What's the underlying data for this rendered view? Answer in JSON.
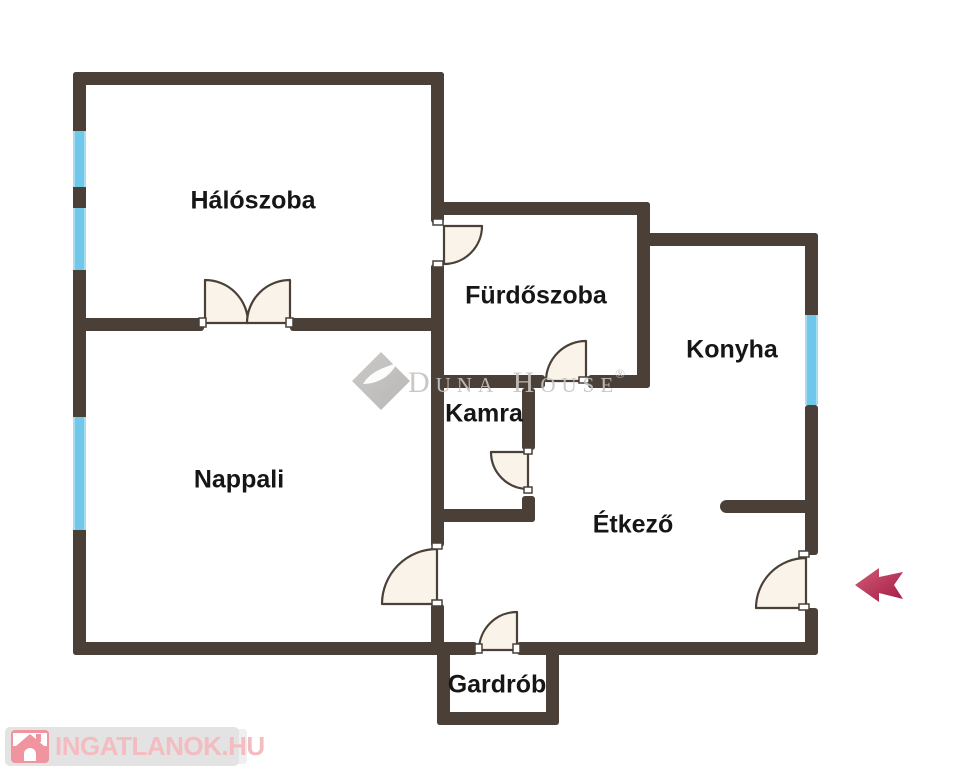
{
  "plan": {
    "title": "apartment-floor-plan",
    "rooms": {
      "bedroom": {
        "label": "Hálószoba"
      },
      "bathroom": {
        "label": "Fürdőszoba"
      },
      "kitchen": {
        "label": "Konyha"
      },
      "pantry": {
        "label": "Kamra"
      },
      "living_room": {
        "label": "Nappali"
      },
      "dining_room": {
        "label": "Étkező"
      },
      "wardrobe": {
        "label": "Gardrób"
      }
    },
    "windows_count": 4,
    "doors": [
      "double-door-bedroom-living",
      "door-bathroom-entry",
      "door-bathroom-hall",
      "door-pantry",
      "door-living-hall",
      "door-entrance",
      "door-wardrobe"
    ]
  },
  "watermark": {
    "brand": "Duna House",
    "registered": "®"
  },
  "footer_logo": {
    "text": "INGATLANOK.HU"
  },
  "icons": {
    "entrance_arrow": "left-arrow-icon",
    "watermark_logo": "diamond-logo-icon",
    "footer": "house-icon"
  },
  "colors": {
    "wall": "#4a4038",
    "window": "#6fc8e9",
    "door_fill": "#faf3ea",
    "door_stroke": "#494038",
    "arrow": "#b01d46",
    "watermark_gray": "#c5c2c0",
    "logo_pink": "#f4bcc1",
    "logo_icon_pink": "#f0949f",
    "logo_panel_gray": "#e3e3e3",
    "label_text": "#161616"
  }
}
